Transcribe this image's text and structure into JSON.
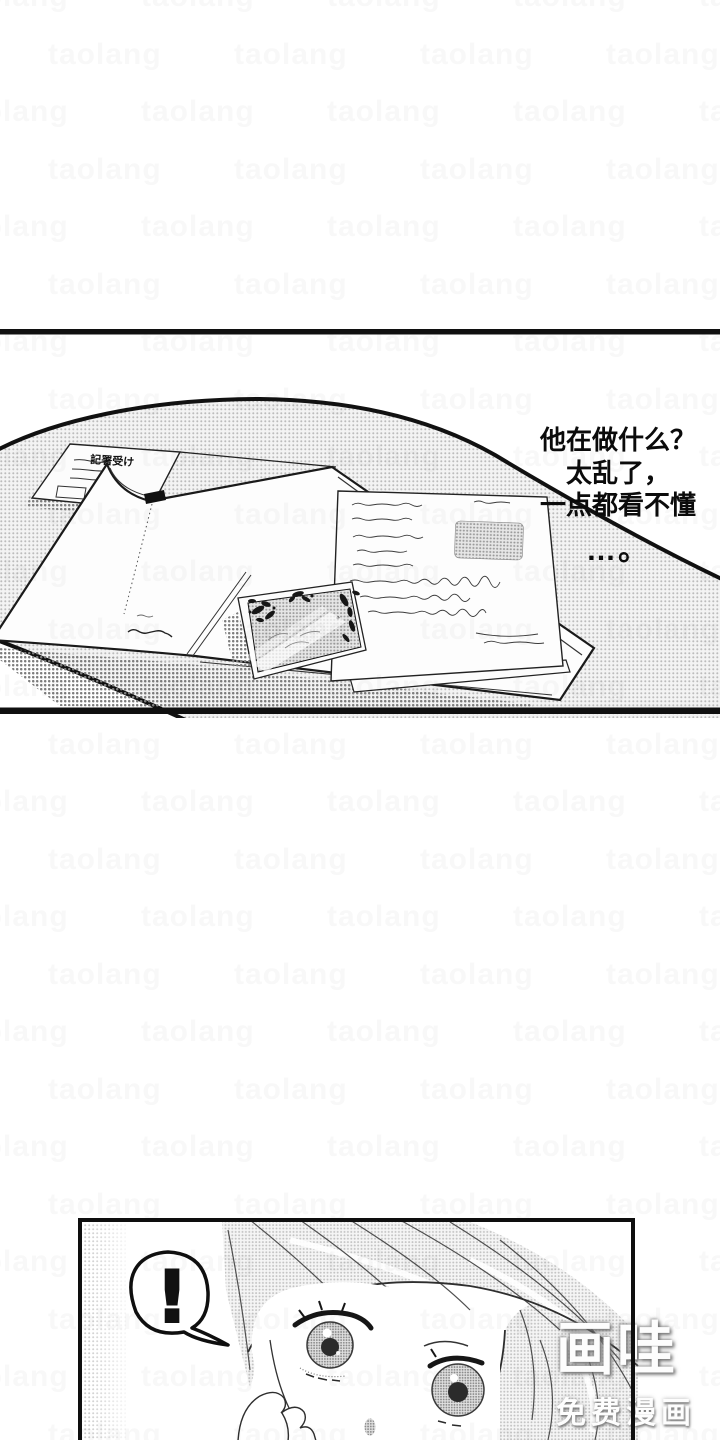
{
  "dialogue": {
    "line1": "他在做什么？",
    "line2": "太乱了，",
    "line3": "一点都看不懂",
    "line4": "…。"
  },
  "bubble": {
    "text": "!"
  },
  "receipt": {
    "title": "記署受け"
  },
  "watermark": {
    "logo": "画哇",
    "tagline": "免费漫画",
    "tile": "taolang"
  },
  "colors": {
    "ink": "#111111",
    "paper": "#ffffff",
    "screentone": "#c9c9c9"
  }
}
